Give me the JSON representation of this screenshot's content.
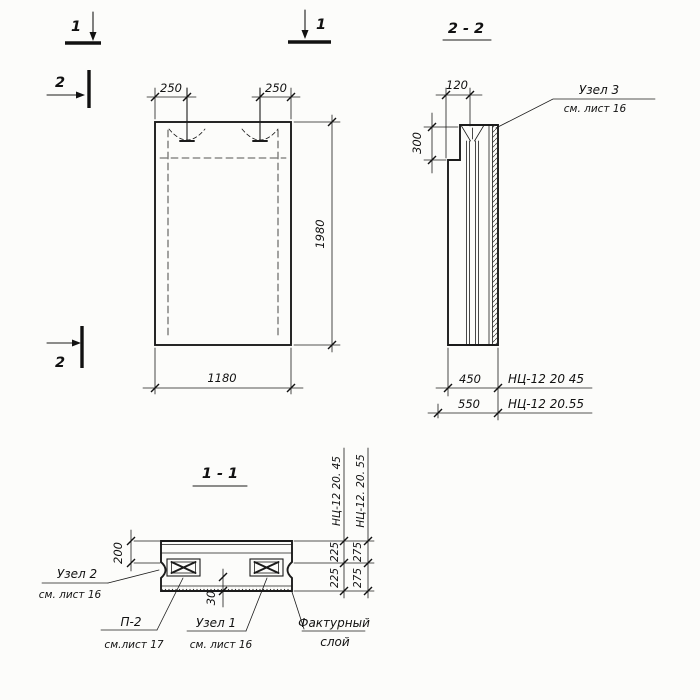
{
  "markers": {
    "plane1": "1",
    "plane2": "2"
  },
  "front_view": {
    "dim_insert_left": "250",
    "dim_insert_right": "250",
    "dim_width": "1180",
    "dim_height": "1980"
  },
  "section22": {
    "title": "2 - 2",
    "dim_step_width": "120",
    "dim_step_height": "300",
    "dim_thick_a": "450",
    "dim_thick_b": "550",
    "mark_a": "НЦ-12 20 45",
    "mark_b": "НЦ-12 20.55",
    "node3": "Узел 3",
    "node3_ref": "см. лист 16"
  },
  "section11": {
    "title": "1 - 1",
    "dim_top": "200",
    "dim_facing": "30",
    "dim_a1": "225",
    "dim_a2": "225",
    "dim_b1": "275",
    "dim_b2": "275",
    "mark_a": "НЦ-12 20. 45",
    "mark_b": "НЦ-12. 20. 55",
    "node2": "Узел 2",
    "node2_ref": "см. лист 16",
    "p2": "П-2",
    "p2_ref": "см.лист 17",
    "node1": "Узел 1",
    "node1_ref": "см. лист 16",
    "facing_label_1": "Фактурный",
    "facing_label_2": "слой"
  }
}
